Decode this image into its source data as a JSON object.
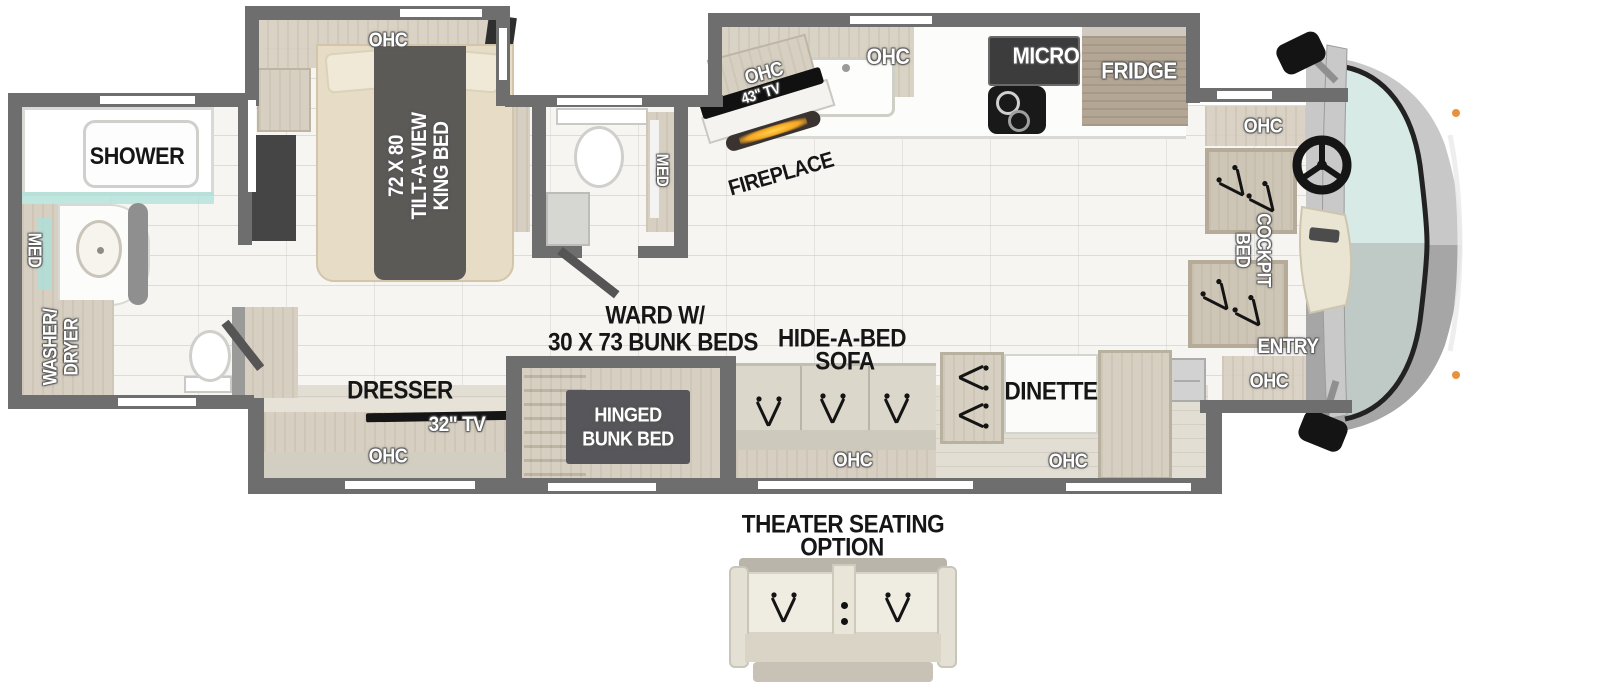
{
  "title": "Motorhome floor plan with bunk beds and theater seating option",
  "colors": {
    "wall": "#6e6e6e",
    "wood": "#d7d0c2",
    "wood-dark": "#b3a694",
    "teal": "#aee0d9",
    "windshield": "#d8eae6",
    "flame": "#f5a623",
    "panel-dark": "#57565a"
  },
  "rear_bath": {
    "shower": "SHOWER",
    "med": "MED",
    "washer_dryer": [
      "WASHER/",
      "DRYER"
    ]
  },
  "bedroom": {
    "ohc": "OHC",
    "bed": [
      "72 X 80",
      "TILT-A-VIEW",
      "KING BED"
    ]
  },
  "mid_bath": {
    "med": "MED"
  },
  "media_wall": {
    "ohc": "OHC",
    "tv": "43\" TV",
    "fireplace": "FIREPLACE"
  },
  "kitchen": {
    "ohc": "OHC",
    "micro": "MICRO",
    "fridge": "FRIDGE"
  },
  "cockpit": {
    "ohc_top": "OHC",
    "bed": [
      "COCKPIT",
      "BED"
    ],
    "entry": "ENTRY",
    "ohc_bottom": "OHC"
  },
  "street_side": {
    "dresser": "DRESSER",
    "tv": "32\" TV",
    "ohc_dresser": "OHC",
    "ward": [
      "WARD W/",
      "30 X 73 BUNK BEDS"
    ],
    "bunk": [
      "HINGED",
      "BUNK BED"
    ],
    "sofa": [
      "HIDE-A-BED",
      "SOFA"
    ],
    "ohc_sofa": "OHC",
    "dinette": "DINETTE",
    "ohc_dinette": "OHC"
  },
  "theater": {
    "label": [
      "THEATER SEATING",
      "OPTION"
    ]
  }
}
